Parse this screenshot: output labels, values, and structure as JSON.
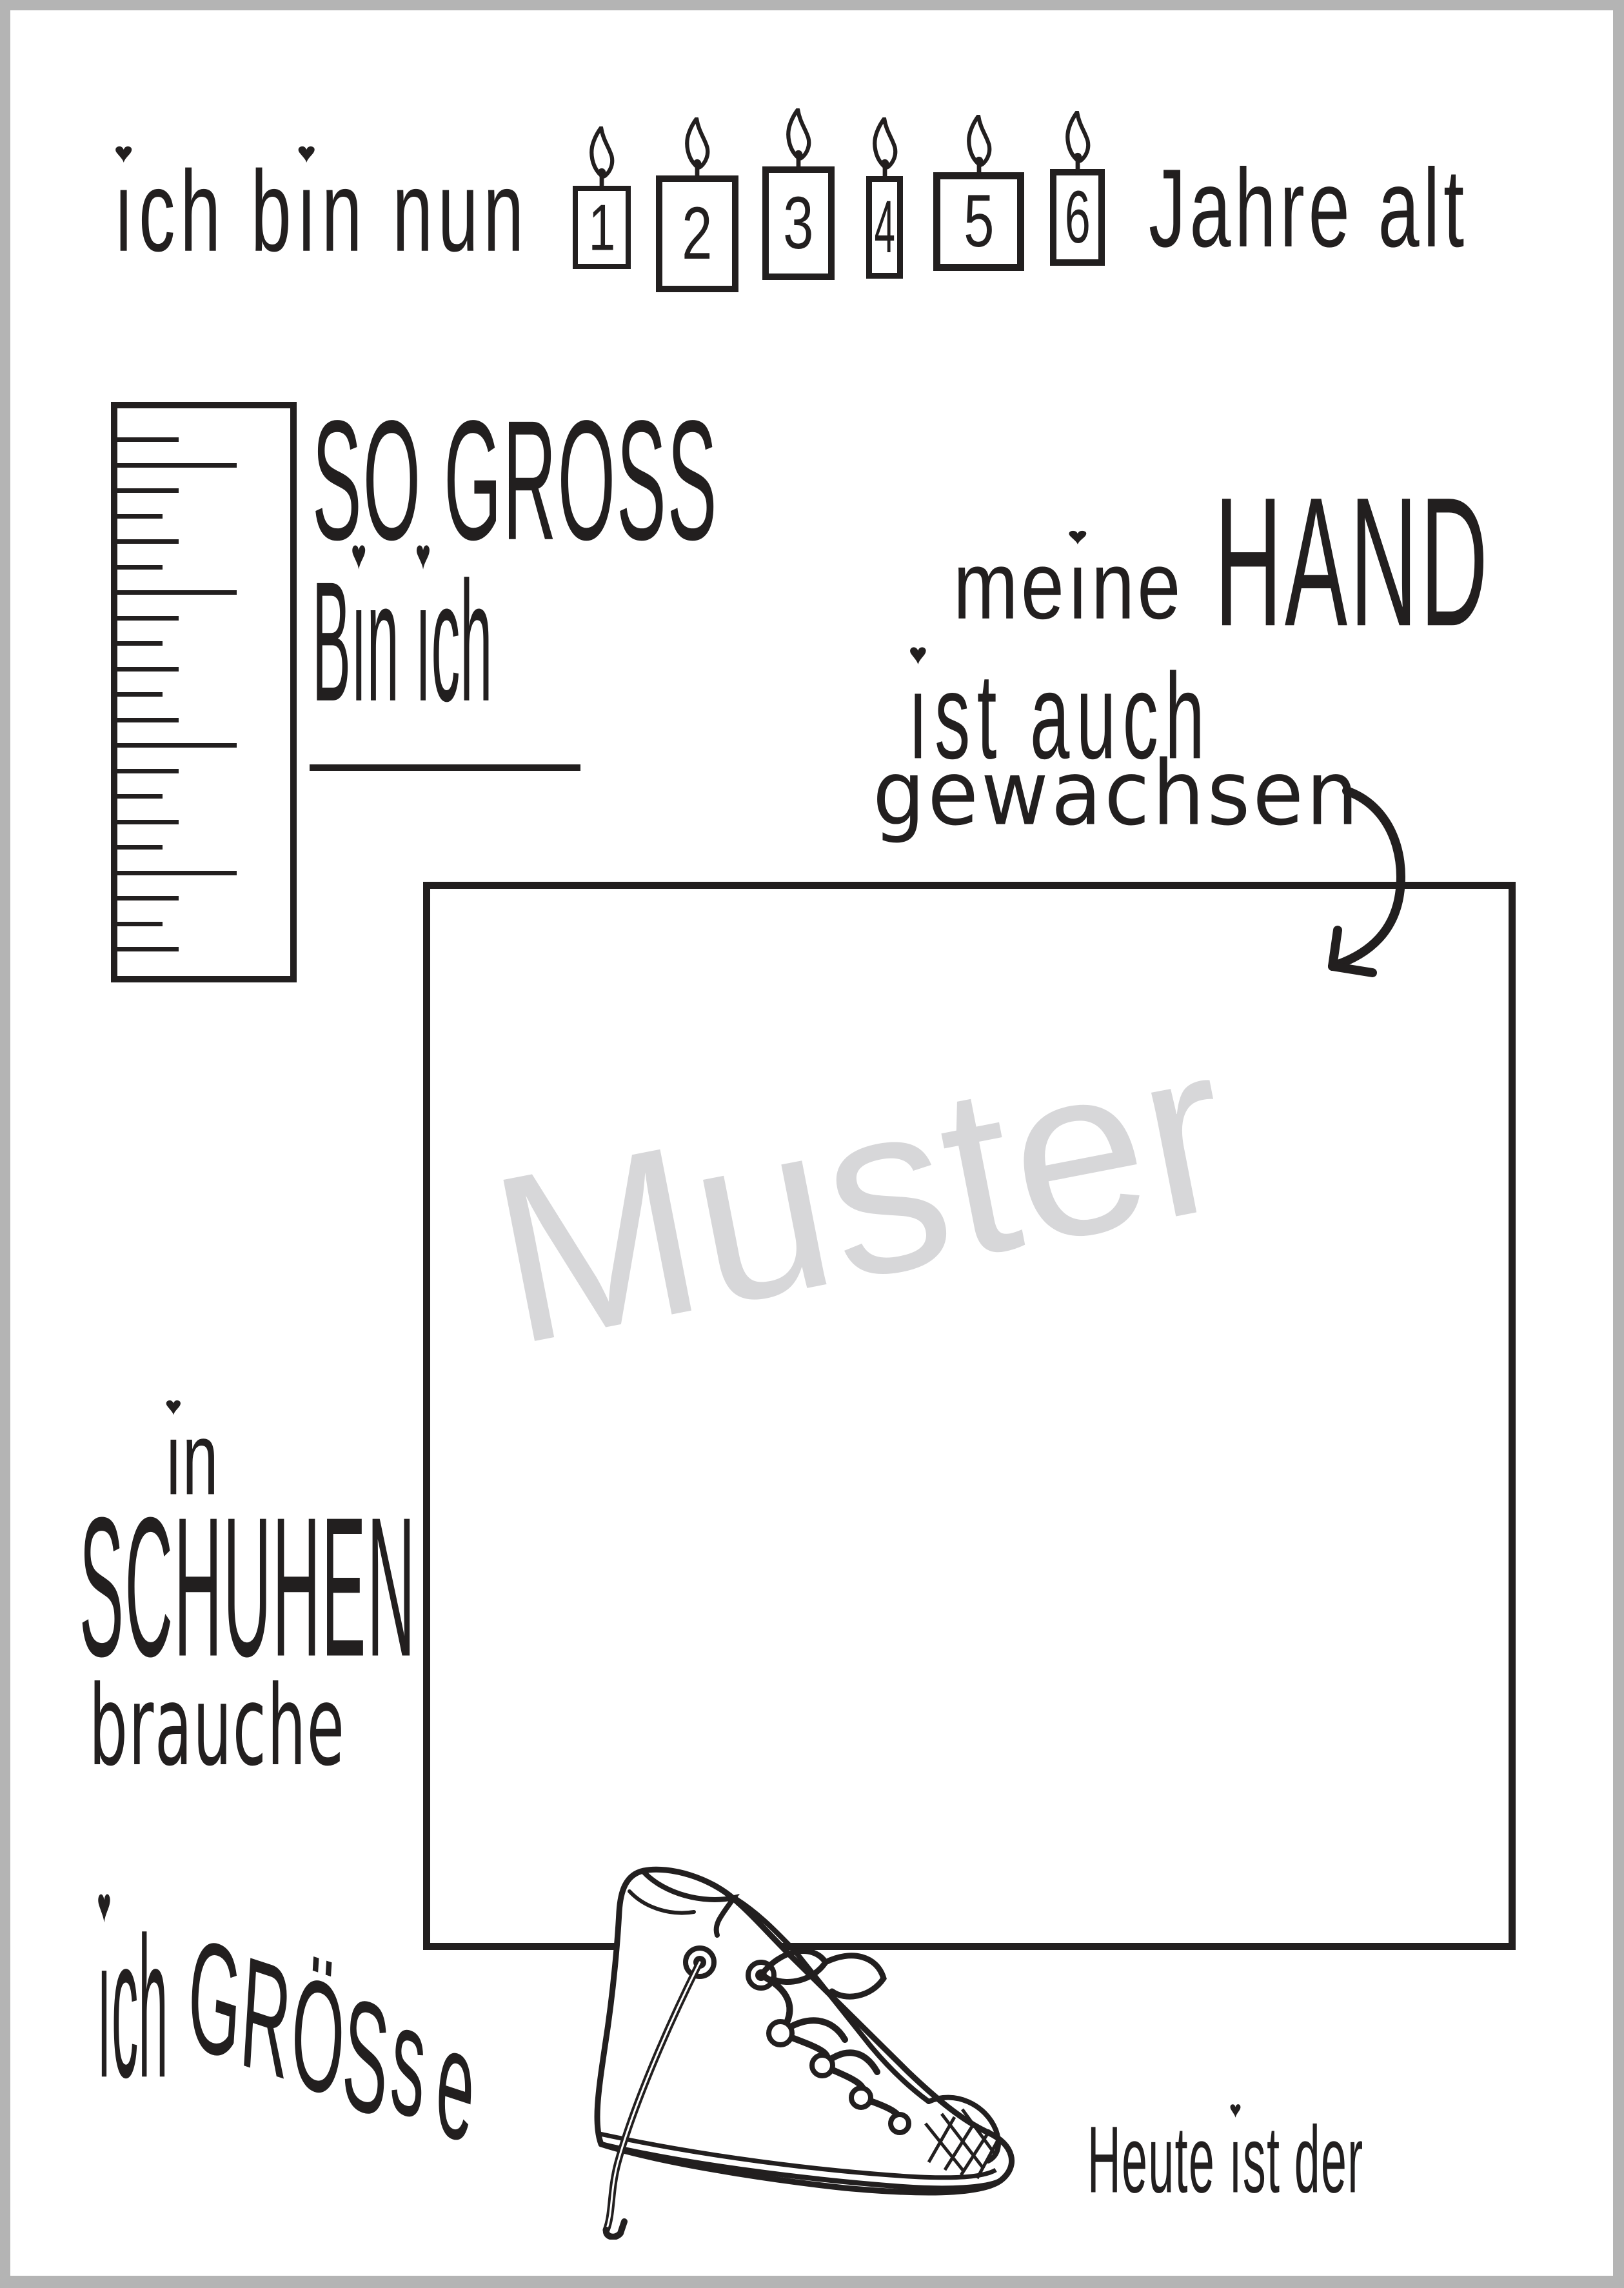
{
  "colors": {
    "ink": "#221f1f",
    "paper": "#ffffff",
    "frame_gray": "#b4b4b4",
    "watermark_gray": "#d7d7d9"
  },
  "header": {
    "text_before_candles": "ich bin nun",
    "text_after_candles": "Jahre alt",
    "candle_numbers": [
      "1",
      "2",
      "3",
      "4",
      "5",
      "6"
    ]
  },
  "height_section": {
    "line1": "SO GROSS",
    "line2": "Bin ich"
  },
  "hand_section": {
    "word_small": "meine",
    "word_large": "HAND",
    "line2": "ist auch",
    "line3": "gewachsen"
  },
  "watermark": {
    "text": "Muster"
  },
  "shoe_section": {
    "line1": "in",
    "line2": "SCHUHEN",
    "line3": "brauche",
    "line4": "ich",
    "size_word_letters": [
      "G",
      "R",
      "Ö",
      "S",
      "s",
      "e"
    ]
  },
  "footer": {
    "date_prompt": "Heute ist der"
  },
  "decorations": {
    "heart_glyph": "♥"
  }
}
